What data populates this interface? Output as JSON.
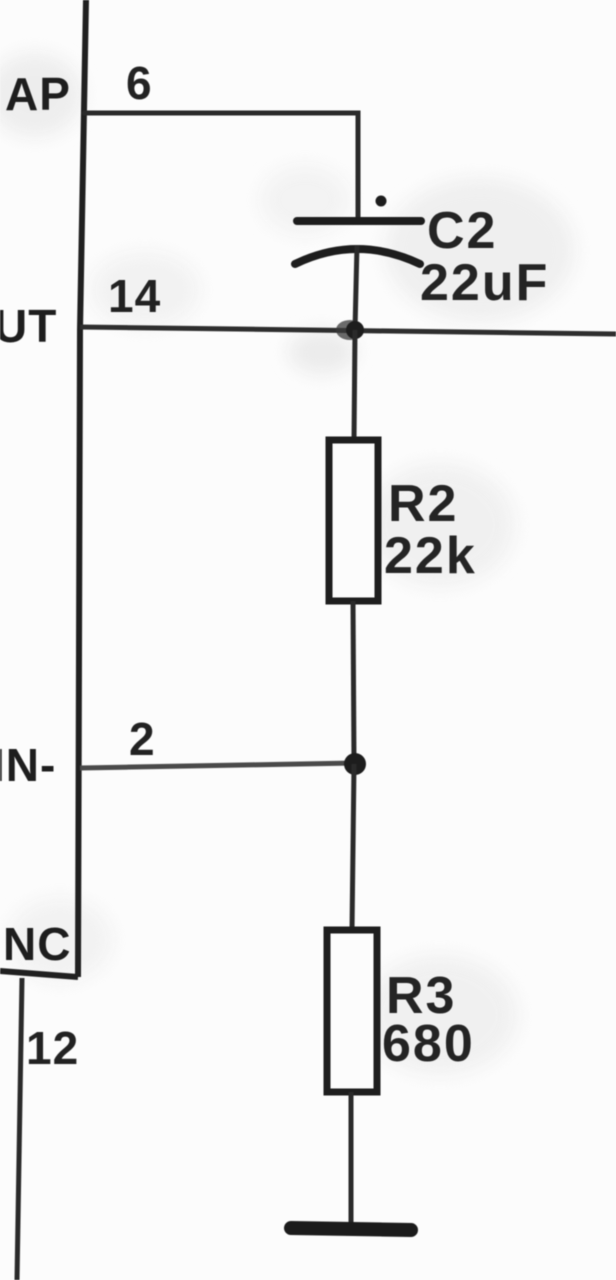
{
  "schematic": {
    "kind": "scanned-circuit-schematic-fragment",
    "ic": {
      "pins": [
        {
          "label": "AP",
          "number": "6"
        },
        {
          "label": "UT",
          "number": "14"
        },
        {
          "label": "IN-",
          "number": "2"
        },
        {
          "label": "NC",
          "number": "12"
        }
      ]
    },
    "components": {
      "c2": {
        "ref": "C2",
        "value": "22uF",
        "type": "polarized-capacitor"
      },
      "r2": {
        "ref": "R2",
        "value": "22k",
        "type": "resistor"
      },
      "r3": {
        "ref": "R3",
        "value": "680",
        "type": "resistor"
      }
    },
    "colors": {
      "ink": "#1e1e1e",
      "wire": "#2e2e2e",
      "paper": "#fcfcfc"
    }
  }
}
